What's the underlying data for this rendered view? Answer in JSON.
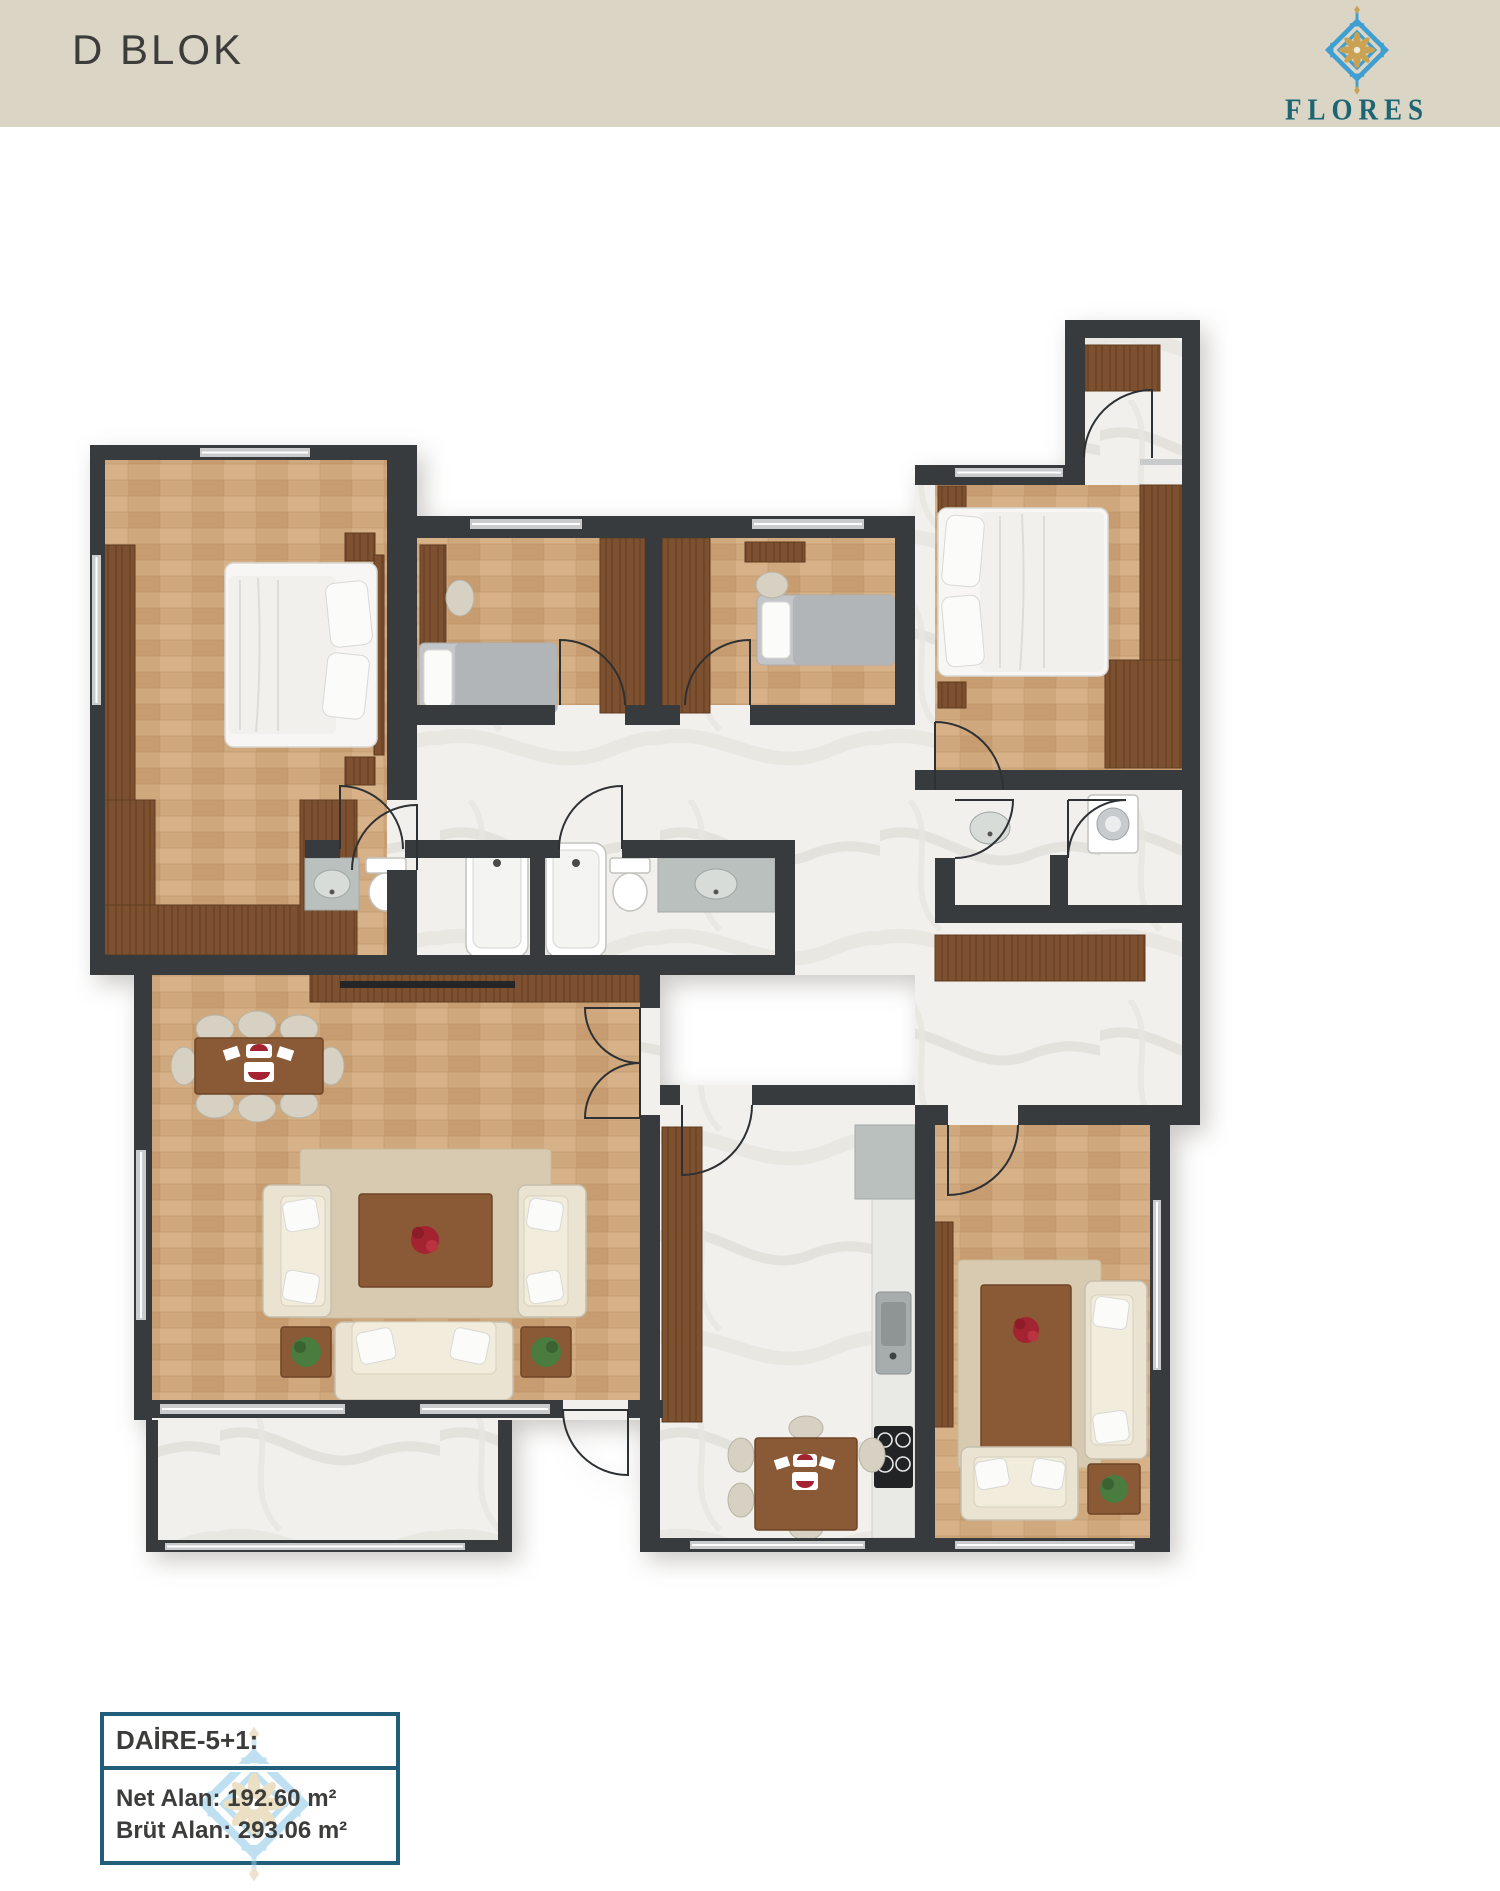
{
  "header": {
    "title": "D BLOK"
  },
  "logo": {
    "text": "FLORES",
    "ornament_icon": "flores-ornament-icon"
  },
  "info_box": {
    "title": "DAİRE-5+1:",
    "net_area": "Net Alan: 192.60 m²",
    "gross_area": "Brüt Alan: 293.06 m²"
  },
  "colors": {
    "header-bg": "#dbd5c6",
    "text-dark": "#3c3c3b",
    "teal": "#1d6574",
    "blue": "#3f9fd1",
    "gold": "#c9a254",
    "wall": "#383b3e",
    "wood": "#cfa87e",
    "wood-dark": "#7d5130",
    "marble": "#f1f0ed",
    "window": "#c9cbcc",
    "cream": "#eae3d2",
    "gray-bed": "#b9bcbe",
    "rug": "#d8cab0",
    "table-wood": "#8a5a36",
    "info-border": "#215e79",
    "plant": "#4a7c3f",
    "red": "#a42331"
  }
}
